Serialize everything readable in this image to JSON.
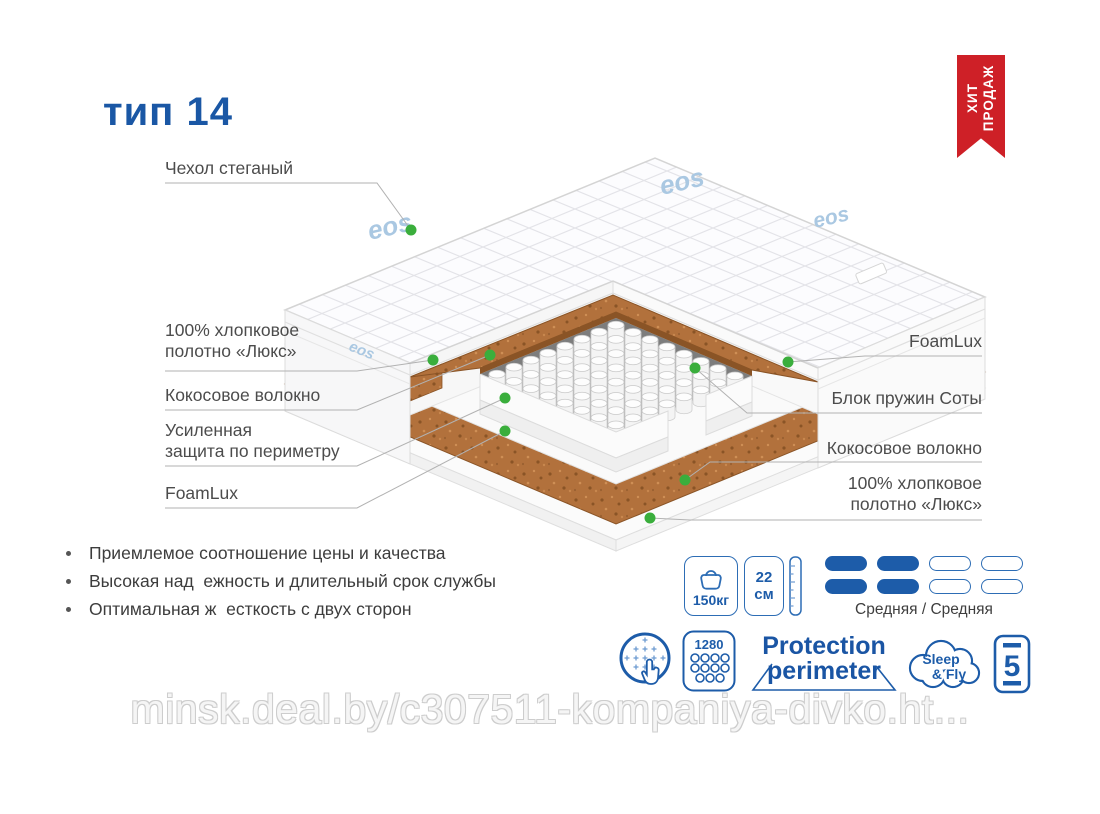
{
  "title": "тип 14",
  "badge": {
    "lines": [
      "ХИТ",
      "ПРОДАЖ"
    ]
  },
  "brand_logo": "eos",
  "callouts_left": [
    {
      "text": "Чехол стеганый"
    },
    {
      "text": "100% хлопковое\nполотно «Люкс»"
    },
    {
      "text": "Кокосовое волокно"
    },
    {
      "text": "Усиленная\nзащита по периметру"
    },
    {
      "text": "FoamLux"
    }
  ],
  "callouts_right": [
    {
      "text": "FoamLux"
    },
    {
      "text": "Блок пружин Соты"
    },
    {
      "text": "Кокосовое волокно"
    },
    {
      "text": "100% хлопковое\nполотно «Люкс»"
    }
  ],
  "bullets": [
    "Приемлемое соотношение цены и качества",
    "Высокая над  ежность и длительный срок службы",
    "Оптимальная ж  есткость с двух сторон"
  ],
  "features": {
    "max_load": "150кг",
    "height_value": "22",
    "height_unit": "см",
    "firmness_label": "Средняя / Средняя",
    "springs_count": "1280",
    "protection_line1": "Protection",
    "protection_line2": "perimeter",
    "brand_line1": "Sleep",
    "brand_line2": "& Fly",
    "warranty_years": "5"
  },
  "watermark": "minsk.deal.by/c307511-kompaniya-divko.ht...",
  "colors": {
    "accent": "#1d5ca9",
    "badge_red": "#ce2027",
    "coir": "#b2713c",
    "dot_green": "#3aae3c"
  }
}
